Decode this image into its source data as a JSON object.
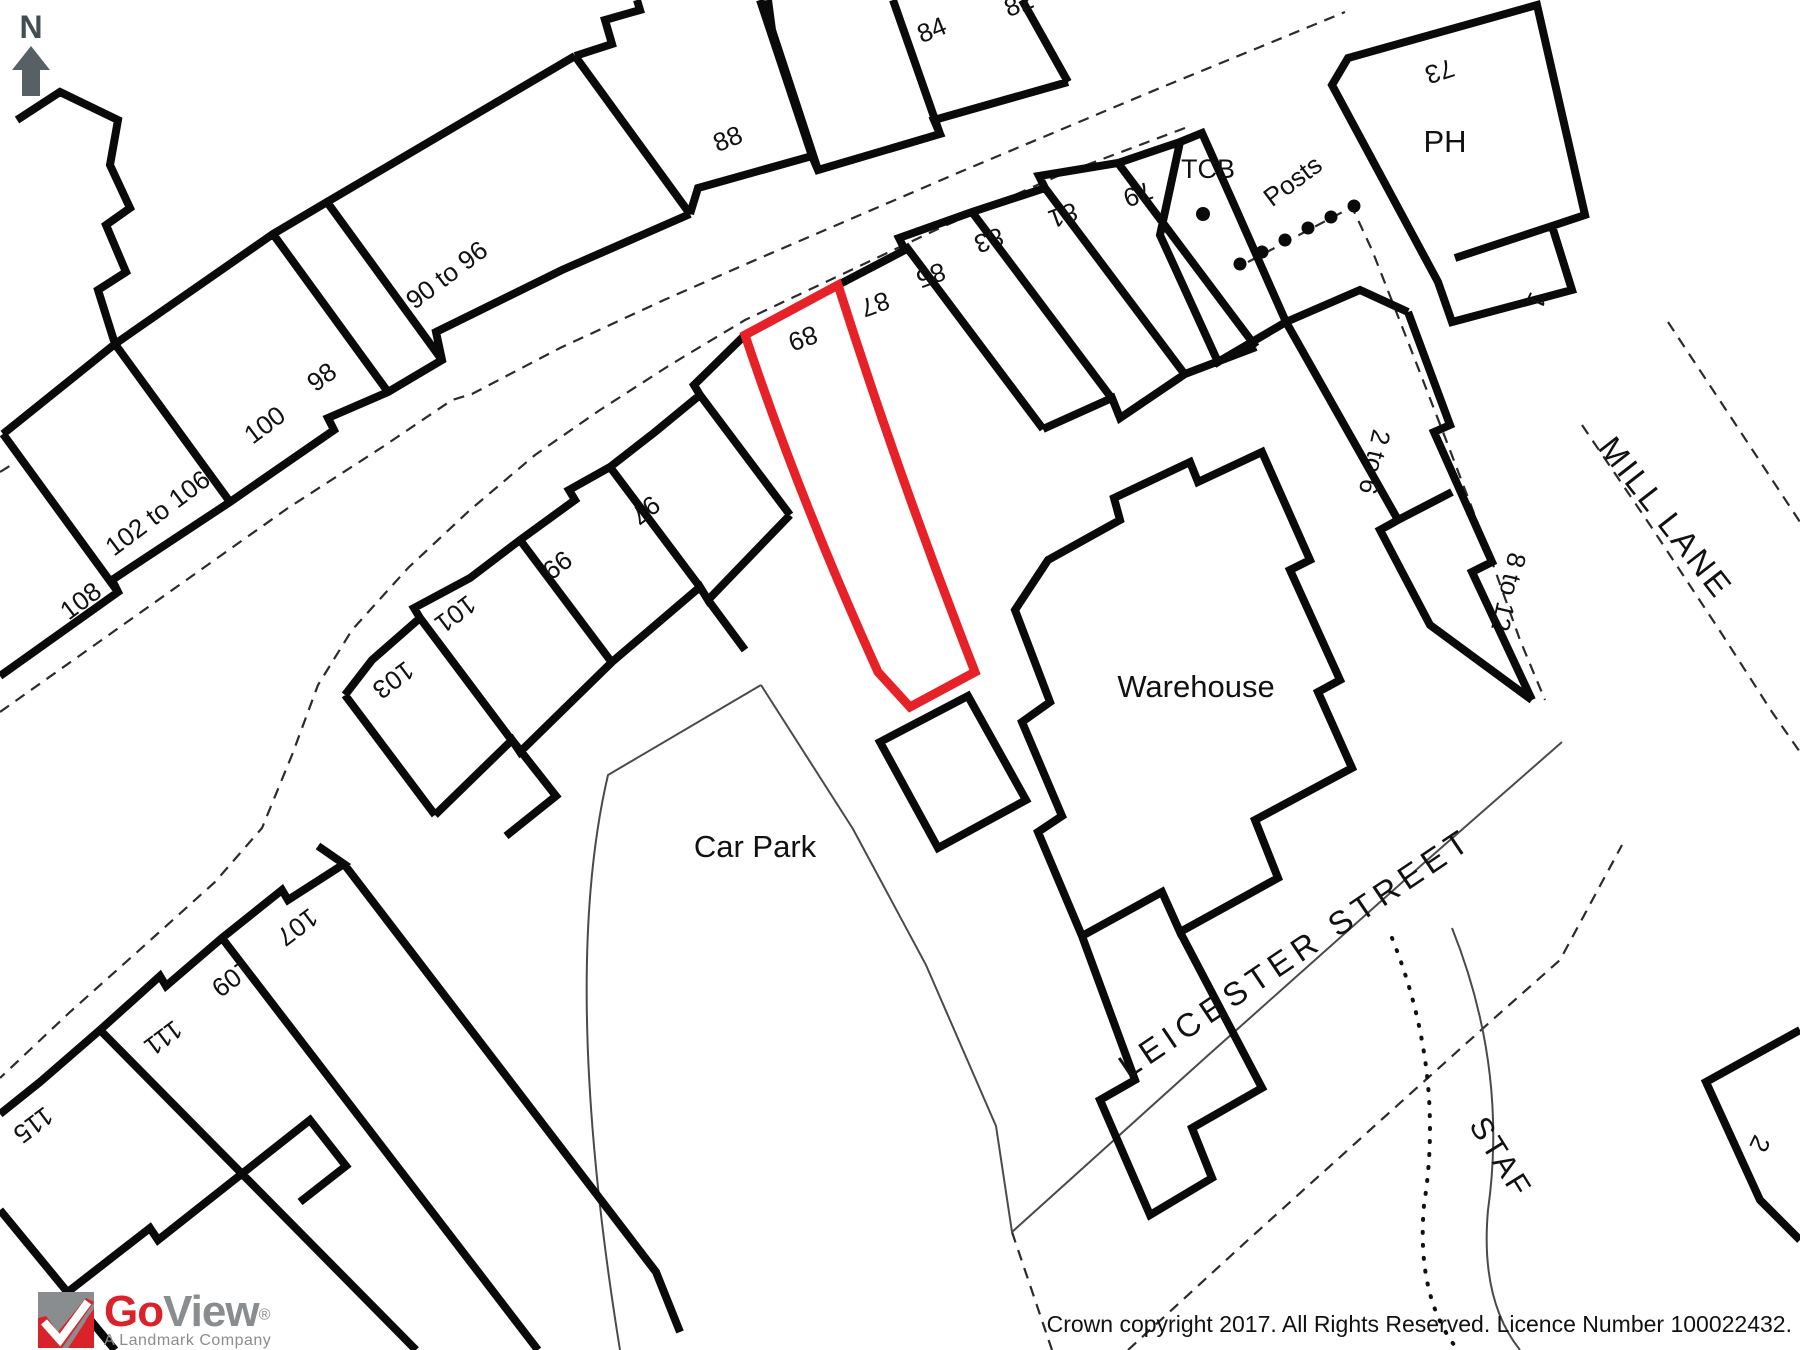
{
  "colors": {
    "plot_outline": "#e62128",
    "building_line": "#0a0a0a",
    "north_arrow": "#4d565c",
    "logo_red": "#d9222a",
    "logo_gray": "#8a8d90"
  },
  "compass": {
    "letter": "N"
  },
  "map": {
    "labels": [
      {
        "id": "house-84",
        "t": "84",
        "x": 935,
        "y": 38,
        "r": -22,
        "s": 26
      },
      {
        "id": "house-82",
        "t": "82",
        "x": 1022,
        "y": 12,
        "r": -22,
        "s": 26
      },
      {
        "id": "house-88",
        "t": "88",
        "x": 731,
        "y": 147,
        "r": -22,
        "s": 26
      },
      {
        "id": "house-90-96",
        "t": "90 to 96",
        "x": 452,
        "y": 282,
        "r": -37,
        "s": 26
      },
      {
        "id": "house-98",
        "t": "98",
        "x": 327,
        "y": 384,
        "r": -37,
        "s": 26
      },
      {
        "id": "house-100",
        "t": "100",
        "x": 270,
        "y": 432,
        "r": -37,
        "s": 26
      },
      {
        "id": "house-102-106",
        "t": "102 to 106",
        "x": 163,
        "y": 520,
        "r": -37,
        "s": 26
      },
      {
        "id": "house-108",
        "t": "108",
        "x": 86,
        "y": 608,
        "r": -37,
        "s": 26
      },
      {
        "id": "house-97",
        "t": "97",
        "x": 640,
        "y": 503,
        "r": 143,
        "s": 26
      },
      {
        "id": "house-99",
        "t": "99",
        "x": 552,
        "y": 558,
        "r": 143,
        "s": 26
      },
      {
        "id": "house-101",
        "t": "101",
        "x": 450,
        "y": 607,
        "r": 143,
        "s": 26
      },
      {
        "id": "house-103",
        "t": "103",
        "x": 388,
        "y": 673,
        "r": 143,
        "s": 26
      },
      {
        "id": "house-89",
        "t": "89",
        "x": 800,
        "y": 330,
        "r": 160,
        "s": 26
      },
      {
        "id": "house-87",
        "t": "87",
        "x": 872,
        "y": 296,
        "r": 160,
        "s": 26
      },
      {
        "id": "house-85",
        "t": "85",
        "x": 928,
        "y": 267,
        "r": 160,
        "s": 26
      },
      {
        "id": "house-83",
        "t": "83",
        "x": 986,
        "y": 232,
        "r": 160,
        "s": 26
      },
      {
        "id": "house-81",
        "t": "81",
        "x": 1060,
        "y": 207,
        "r": 160,
        "s": 26
      },
      {
        "id": "house-79",
        "t": "79",
        "x": 1135,
        "y": 186,
        "r": 160,
        "s": 26
      },
      {
        "id": "tcb",
        "t": "TCB",
        "x": 1208,
        "y": 178,
        "r": 0,
        "s": 27
      },
      {
        "id": "posts",
        "t": "Posts",
        "x": 1298,
        "y": 188,
        "r": -37,
        "s": 26
      },
      {
        "id": "house-73",
        "t": "73",
        "x": 1437,
        "y": 63,
        "r": 162,
        "s": 26
      },
      {
        "id": "ph",
        "t": "PH",
        "x": 1445,
        "y": 152,
        "r": 0,
        "s": 31
      },
      {
        "id": "house-1",
        "t": "1",
        "x": 1528,
        "y": 297,
        "r": 115,
        "s": 26
      },
      {
        "id": "house-2-6",
        "t": "2 to 6",
        "x": 1366,
        "y": 460,
        "r": 103,
        "s": 26
      },
      {
        "id": "house-8-12",
        "t": "8 to 12",
        "x": 1500,
        "y": 590,
        "r": 103,
        "s": 26
      },
      {
        "id": "street-mill-lane",
        "t": "MILL LANE",
        "x": 1597,
        "y": 448,
        "r": 52,
        "s": 33,
        "ls": 3,
        "anchor": "start"
      },
      {
        "id": "warehouse",
        "t": "Warehouse",
        "x": 1196,
        "y": 697,
        "r": 0,
        "s": 31
      },
      {
        "id": "car-park",
        "t": "Car Park",
        "x": 755,
        "y": 857,
        "r": 0,
        "s": 31
      },
      {
        "id": "street-leicester",
        "t": "LEICESTER STREET",
        "x": 1302,
        "y": 962,
        "r": -34,
        "s": 33,
        "ls": 6
      },
      {
        "id": "street-staf",
        "t": "STAF",
        "x": 1492,
        "y": 1163,
        "r": 58,
        "s": 31,
        "ls": 3
      },
      {
        "id": "house-107",
        "t": "107",
        "x": 292,
        "y": 920,
        "r": 143,
        "s": 26
      },
      {
        "id": "house-109",
        "t": "109",
        "x": 227,
        "y": 971,
        "r": 143,
        "s": 26
      },
      {
        "id": "house-111",
        "t": "111",
        "x": 158,
        "y": 1031,
        "r": 143,
        "s": 26
      },
      {
        "id": "house-115",
        "t": "115",
        "x": 28,
        "y": 1118,
        "r": 143,
        "s": 26
      },
      {
        "id": "house-2",
        "t": "2",
        "x": 1752,
        "y": 1140,
        "r": 115,
        "s": 26
      }
    ],
    "highlighted_plot_number": "89"
  },
  "logo": {
    "word1": "Go",
    "word2": "View",
    "registered": "®",
    "tagline": "A Landmark Company"
  },
  "footer": {
    "copyright": "Crown copyright 2017. All Rights Reserved. Licence Number 100022432."
  }
}
